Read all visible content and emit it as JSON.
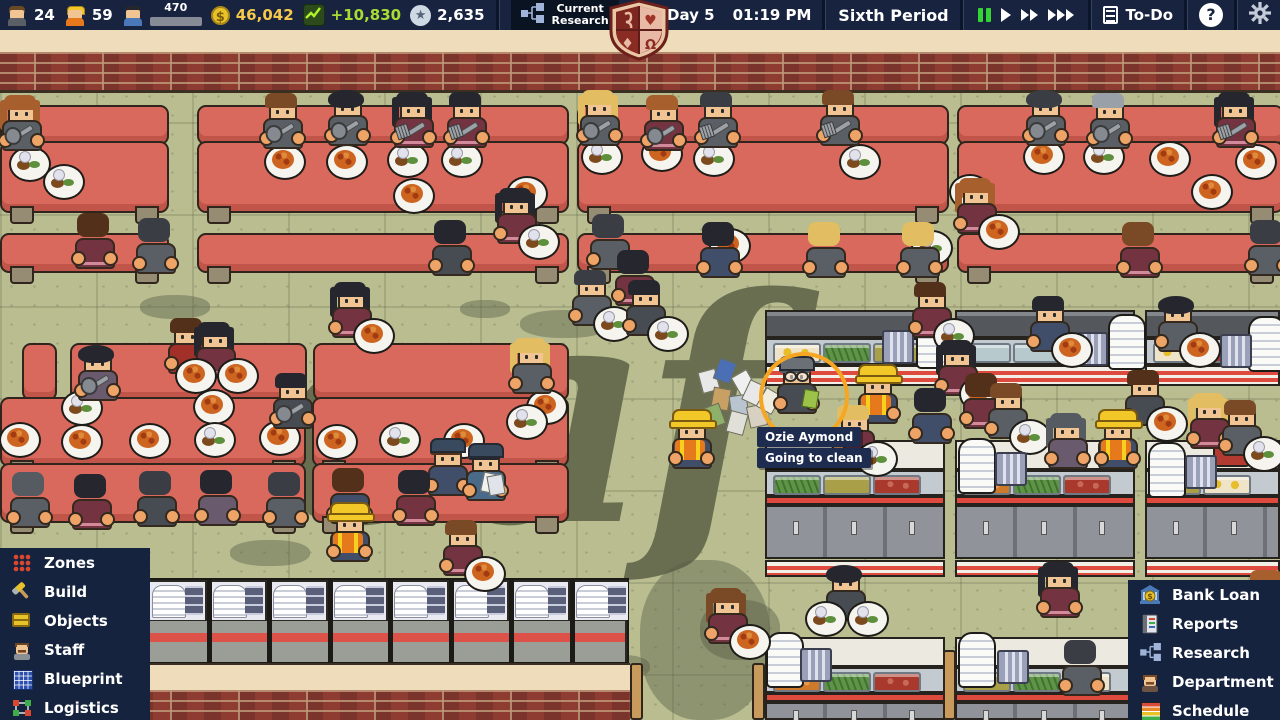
{
  "top_bar": {
    "stats": [
      {
        "id": "teachers",
        "icon": "teacher-icon",
        "value": "24"
      },
      {
        "id": "workers",
        "icon": "worker-icon",
        "value": "59"
      },
      {
        "id": "students",
        "icon": "student-icon",
        "value": "470",
        "bar_pct": 62
      },
      {
        "id": "money",
        "icon": "coin-icon",
        "value": "46,042",
        "color": "#f5c84c"
      },
      {
        "id": "income",
        "icon": "graph-icon",
        "value": "+10,830",
        "color": "#a8dc32"
      },
      {
        "id": "points",
        "icon": "star-icon",
        "value": "2,635"
      }
    ],
    "research_label": "Current\nResearch",
    "date_year": "Y7",
    "date_day": "Day 5",
    "time": "01:19 PM",
    "period": "Sixth Period",
    "todo_label": "To-Do",
    "help_label": "?",
    "crest_symbols": [
      "scroll",
      "heart",
      "diamond",
      "omega"
    ]
  },
  "left_menu": {
    "items": [
      {
        "id": "zones",
        "label": "Zones"
      },
      {
        "id": "build",
        "label": "Build"
      },
      {
        "id": "objects",
        "label": "Objects"
      },
      {
        "id": "staff",
        "label": "Staff"
      },
      {
        "id": "blueprint",
        "label": "Blueprint"
      },
      {
        "id": "logistics",
        "label": "Logistics"
      }
    ]
  },
  "right_menu": {
    "items": [
      {
        "id": "bank-loan",
        "label": "Bank Loan"
      },
      {
        "id": "reports",
        "label": "Reports"
      },
      {
        "id": "research",
        "label": "Research"
      },
      {
        "id": "department",
        "label": "Department"
      },
      {
        "id": "schedule",
        "label": "Schedule"
      }
    ]
  },
  "tooltip": {
    "name": "Ozie Aymond",
    "status": "Going to clean"
  },
  "colors": {
    "bar_bg": "#17233f",
    "menu_bg": "#16233e",
    "money_yellow": "#f5c84c",
    "income_green": "#a8dc32",
    "pause_green": "#35d435",
    "floor": "#b9bd90",
    "table": "#d9695c",
    "selection_orange": "#f5a623",
    "tooltip_bg": "#1e2c50",
    "crest_red": "#993128",
    "crest_pink": "#e8b9a4"
  },
  "scene": {
    "floor_label": "caf",
    "strips": [
      {
        "y": 105,
        "h": 36,
        "legs": false,
        "segs": [
          [
            0,
            165
          ],
          [
            197,
            368
          ],
          [
            577,
            368
          ],
          [
            957,
            323
          ]
        ]
      },
      {
        "y": 141,
        "h": 68,
        "legs": true,
        "segs": [
          [
            0,
            165
          ],
          [
            197,
            368
          ],
          [
            577,
            368
          ],
          [
            957,
            323
          ]
        ]
      },
      {
        "y": 233,
        "h": 36,
        "legs": true,
        "segs": [
          [
            0,
            165
          ],
          [
            197,
            368
          ],
          [
            577,
            368
          ],
          [
            957,
            323
          ]
        ]
      },
      {
        "y": 343,
        "h": 54,
        "legs": false,
        "segs": [
          [
            22,
            31
          ],
          [
            70,
            233
          ],
          [
            313,
            252
          ]
        ]
      },
      {
        "y": 397,
        "h": 66,
        "legs": true,
        "segs": [
          [
            0,
            302
          ],
          [
            312,
            253
          ]
        ]
      },
      {
        "y": 463,
        "h": 56,
        "legs": true,
        "segs": [
          [
            0,
            302
          ],
          [
            312,
            253
          ]
        ]
      }
    ],
    "plates": [
      [
        28,
        162,
        "m"
      ],
      [
        62,
        180,
        "m"
      ],
      [
        283,
        160,
        "s"
      ],
      [
        345,
        160,
        "s"
      ],
      [
        406,
        158,
        "m"
      ],
      [
        460,
        158,
        "m"
      ],
      [
        412,
        194,
        "s"
      ],
      [
        525,
        192,
        "s"
      ],
      [
        600,
        155,
        "m"
      ],
      [
        660,
        152,
        "s"
      ],
      [
        712,
        157,
        "m"
      ],
      [
        858,
        160,
        "m"
      ],
      [
        968,
        190,
        "s"
      ],
      [
        1042,
        155,
        "s"
      ],
      [
        1102,
        155,
        "m"
      ],
      [
        1168,
        157,
        "s"
      ],
      [
        1210,
        190,
        "s"
      ],
      [
        1254,
        160,
        "s"
      ],
      [
        728,
        244,
        "s"
      ],
      [
        930,
        246,
        "m"
      ],
      [
        18,
        438,
        "s"
      ],
      [
        80,
        406,
        "m"
      ],
      [
        80,
        440,
        "s"
      ],
      [
        148,
        439,
        "s"
      ],
      [
        212,
        405,
        "s"
      ],
      [
        213,
        438,
        "m"
      ],
      [
        278,
        436,
        "s"
      ],
      [
        335,
        440,
        "s"
      ],
      [
        398,
        438,
        "m"
      ],
      [
        462,
        439,
        "s"
      ],
      [
        525,
        420,
        "m"
      ],
      [
        545,
        405,
        "s"
      ]
    ],
    "persons": [
      [
        2,
        95,
        "auburn",
        "gray",
        "d",
        {
          "l": 1,
          "i": "sp"
        }
      ],
      [
        263,
        93,
        "brown",
        "gray",
        "d",
        {
          "i": "sp"
        }
      ],
      [
        328,
        90,
        "black",
        "gray",
        "d",
        {
          "a": 1,
          "i": "sp"
        }
      ],
      [
        394,
        92,
        "black",
        "maroon",
        "d",
        {
          "l": 1,
          "i": "fk"
        }
      ],
      [
        447,
        92,
        "black",
        "maroon",
        "d",
        {
          "i": "fk"
        }
      ],
      [
        580,
        90,
        "blonde",
        "gray",
        "d",
        {
          "l": 1,
          "i": "sp"
        }
      ],
      [
        644,
        95,
        "auburn",
        "maroon",
        "d",
        {
          "i": "sp"
        }
      ],
      [
        698,
        92,
        "dkgray",
        "gray",
        "d",
        {
          "i": "fk"
        }
      ],
      [
        820,
        90,
        "brown",
        "gray",
        "d",
        {
          "i": "fk"
        }
      ],
      [
        1026,
        90,
        "dkgray",
        "gray",
        "d",
        {
          "a": 1,
          "i": "sp"
        }
      ],
      [
        1090,
        93,
        "silver",
        "gray",
        "d",
        {
          "i": "sp"
        }
      ],
      [
        1216,
        92,
        "black",
        "maroon",
        "d",
        {
          "l": 1,
          "i": "fk"
        }
      ],
      [
        75,
        213,
        "dkbrown",
        "maroon",
        "u",
        null
      ],
      [
        136,
        218,
        "dkgray",
        "gray",
        "u",
        null
      ],
      [
        432,
        220,
        "black",
        "dkgray",
        "u",
        null
      ],
      [
        590,
        214,
        "dkgray",
        "gray",
        "u",
        null
      ],
      [
        615,
        250,
        "black",
        "maroon",
        "u",
        null
      ],
      [
        700,
        222,
        "black",
        "navy",
        "u",
        null
      ],
      [
        806,
        222,
        "blonde",
        "gray",
        "u",
        null
      ],
      [
        900,
        222,
        "blonde",
        "gray",
        "u",
        null
      ],
      [
        1120,
        222,
        "brown",
        "maroon",
        "u",
        null
      ],
      [
        1248,
        220,
        "dkgray",
        "gray",
        "u",
        null
      ],
      [
        497,
        188,
        "black",
        "maroon",
        "d",
        {
          "l": 1,
          "i": "pm"
        }
      ],
      [
        957,
        178,
        "auburn",
        "maroon",
        "d",
        {
          "l": 1,
          "i": "ps"
        }
      ],
      [
        332,
        282,
        "black",
        "maroon",
        "d",
        {
          "l": 1,
          "i": "ps"
        }
      ],
      [
        572,
        270,
        "dkgray",
        "gray",
        "d",
        {
          "i": "pm"
        }
      ],
      [
        626,
        280,
        "black",
        "dkgray",
        "d",
        {
          "i": "pm"
        }
      ],
      [
        912,
        282,
        "dkbrown",
        "maroon",
        "d",
        {
          "i": "pm"
        }
      ],
      [
        1030,
        296,
        "black",
        "navy",
        "d",
        {
          "i": "ps"
        }
      ],
      [
        1158,
        296,
        "black",
        "gray",
        "d",
        {
          "a": 1,
          "i": "ps"
        }
      ],
      [
        78,
        345,
        "black",
        "purple",
        "d",
        {
          "a": 1,
          "i": "sp"
        }
      ],
      [
        512,
        338,
        "blonde",
        "gray",
        "d",
        {
          "l": 1
        }
      ],
      [
        273,
        373,
        "black",
        "dkgray",
        "d",
        {
          "i": "sp"
        }
      ],
      [
        168,
        318,
        "dkbrown",
        "red",
        "d",
        null
      ],
      [
        196,
        322,
        "black",
        "maroon",
        "d",
        {
          "l": 1,
          "i": "ps",
          "i2": "ps"
        }
      ],
      [
        938,
        340,
        "black",
        "maroon",
        "d",
        {
          "l": 1,
          "i": "ps"
        }
      ],
      [
        10,
        472,
        "gray",
        "gray",
        "u",
        null
      ],
      [
        72,
        474,
        "black",
        "maroon",
        "u",
        null
      ],
      [
        137,
        471,
        "dkgray",
        "dkgray",
        "u",
        null
      ],
      [
        198,
        470,
        "black",
        "purple",
        "u",
        null
      ],
      [
        266,
        472,
        "dkgray",
        "gray",
        "u",
        null
      ],
      [
        330,
        468,
        "dkbrown",
        "navy",
        "u",
        null
      ],
      [
        396,
        470,
        "black",
        "maroon",
        "u",
        null
      ],
      [
        428,
        440,
        "dkbrown",
        "navy",
        "d",
        {
          "h": "cap"
        }
      ],
      [
        466,
        445,
        "black",
        "blue",
        "d",
        {
          "h": "cap",
          "i": "pp"
        }
      ],
      [
        443,
        520,
        "brown",
        "maroon",
        "d",
        {
          "i": "ps"
        }
      ],
      [
        330,
        506,
        "brown",
        "navy",
        "d",
        {
          "h": "hard",
          "v": 1
        }
      ],
      [
        672,
        413,
        "brown",
        "navy",
        "d",
        {
          "h": "hard",
          "v": 1
        }
      ],
      [
        858,
        368,
        "dkbrown",
        "navy",
        "d",
        {
          "h": "hard",
          "v": 1
        }
      ],
      [
        1098,
        413,
        "blonde",
        "navy",
        "d",
        {
          "h": "hard",
          "v": 1
        }
      ],
      [
        777,
        358,
        "gray",
        "dkgray",
        "d",
        {
          "h": "gray",
          "g": 1,
          "i": "pg",
          "janitor": 1
        }
      ],
      [
        963,
        373,
        "dkbrown",
        "maroon",
        "u",
        null
      ],
      [
        988,
        383,
        "brown",
        "gray",
        "d",
        {
          "i": "pm"
        }
      ],
      [
        1048,
        413,
        "gray",
        "purple",
        "d",
        {
          "l": 1
        }
      ],
      [
        1125,
        370,
        "dkbrown",
        "dkgray",
        "d",
        {
          "i": "ps"
        }
      ],
      [
        1190,
        393,
        "blonde",
        "maroon",
        "d",
        {
          "l": 1
        }
      ],
      [
        1222,
        400,
        "brown",
        "gray",
        "d",
        {
          "i": "pm"
        }
      ],
      [
        835,
        405,
        "blonde",
        "maroon",
        "d",
        {
          "i": "pm"
        }
      ],
      [
        912,
        388,
        "black",
        "navy",
        "u",
        null
      ],
      [
        826,
        565,
        "black",
        "dkgray",
        "d",
        {
          "a": 1,
          "i": "pm",
          "i2": "pm"
        }
      ],
      [
        708,
        588,
        "brown",
        "maroon",
        "d",
        {
          "l": 1,
          "i": "ps"
        }
      ],
      [
        1040,
        562,
        "black",
        "maroon",
        "d",
        {
          "l": 1
        }
      ],
      [
        1248,
        570,
        "auburn",
        "maroon",
        "d",
        null
      ],
      [
        1188,
        605,
        "blonde",
        "maroon",
        "d",
        {
          "l": 1
        }
      ],
      [
        1062,
        640,
        "dkgray",
        "gray",
        "u",
        null
      ]
    ],
    "stations": {
      "cols": [
        {
          "x": 765,
          "w": 180,
          "glass": [
            "eggs",
            "greens",
            "olive"
          ],
          "food1": [
            "greens",
            "olive",
            "red"
          ],
          "food2": [
            "carrot",
            "greens",
            "red"
          ]
        },
        {
          "x": 955,
          "w": 180,
          "glass": [
            "glass",
            "glass",
            "glassg"
          ],
          "food1": [
            "carrot",
            "greens",
            "red"
          ],
          "food2": [
            "olive",
            "greens",
            "eggs"
          ]
        },
        {
          "x": 1145,
          "w": 135,
          "glass": [
            "eggs",
            "red"
          ],
          "food1": [
            "olive",
            "eggs"
          ],
          "food2": [
            "olive",
            "greens"
          ]
        }
      ],
      "row1": {
        "y": 310,
        "band": 28,
        "glass": 27,
        "rail": 21,
        "open": 54,
        "counter": 30,
        "food": 26,
        "stripe": 9,
        "cab": 54
      },
      "row2": {
        "y": 560,
        "rail": 17,
        "open": 60,
        "counter": 30,
        "food": 26,
        "stripe": 9,
        "cab": 18
      }
    },
    "stacks": [
      [
        916,
        313
      ],
      [
        1108,
        314
      ],
      [
        1248,
        316
      ],
      [
        958,
        438
      ],
      [
        1148,
        442
      ],
      [
        766,
        632
      ],
      [
        958,
        632
      ],
      [
        1230,
        636
      ]
    ],
    "utensils": [
      [
        882,
        330
      ],
      [
        1076,
        332
      ],
      [
        1220,
        334
      ],
      [
        995,
        452
      ],
      [
        1185,
        455
      ],
      [
        800,
        648
      ],
      [
        997,
        650
      ],
      [
        1245,
        652
      ]
    ],
    "counter_row": {
      "x": 145,
      "y": 578,
      "w": 484,
      "h": 86,
      "modules": 8
    },
    "walls": {
      "top_cream": [
        0,
        30,
        1280,
        22
      ],
      "top_brick": [
        0,
        52,
        1280,
        38
      ],
      "bottom_cream": [
        0,
        663,
        630,
        27
      ],
      "bottom_brick": [
        0,
        690,
        630,
        30
      ]
    },
    "posts": [
      [
        630,
        663,
        57
      ],
      [
        752,
        663,
        57
      ],
      [
        943,
        650,
        70
      ]
    ],
    "stains": [
      [
        140,
        295,
        70,
        24
      ],
      [
        520,
        310,
        90,
        28
      ],
      [
        230,
        540,
        80,
        26
      ],
      [
        640,
        560,
        130,
        160
      ],
      [
        1055,
        515,
        60,
        20
      ],
      [
        595,
        655,
        55,
        24
      ],
      [
        460,
        300,
        50,
        18
      ],
      [
        985,
        245,
        60,
        18
      ],
      [
        700,
        600,
        80,
        60
      ]
    ],
    "trash": [
      [
        700,
        370,
        -15,
        "#e8e8e8"
      ],
      [
        716,
        360,
        20,
        "#4a6fb5"
      ],
      [
        735,
        372,
        -30,
        "#f0f0f0"
      ],
      [
        712,
        388,
        10,
        "#c9a063"
      ],
      [
        730,
        395,
        -8,
        "#b8c4d0"
      ],
      [
        745,
        382,
        25,
        "#e8e8e8"
      ],
      [
        705,
        405,
        -20,
        "#8fb06a"
      ],
      [
        728,
        412,
        15,
        "#e0e0d8"
      ],
      [
        748,
        405,
        -12,
        "#d8d0c0"
      ],
      [
        760,
        390,
        30,
        "#f0ece0"
      ]
    ],
    "cart": {
      "x": 1213,
      "y": 412,
      "w": 38,
      "h": 55
    },
    "selection": {
      "x": 759,
      "y": 352,
      "d": 82
    },
    "tooltip_pos": {
      "name_x": 757,
      "name_y": 427,
      "status_x": 757,
      "status_y": 448
    }
  }
}
